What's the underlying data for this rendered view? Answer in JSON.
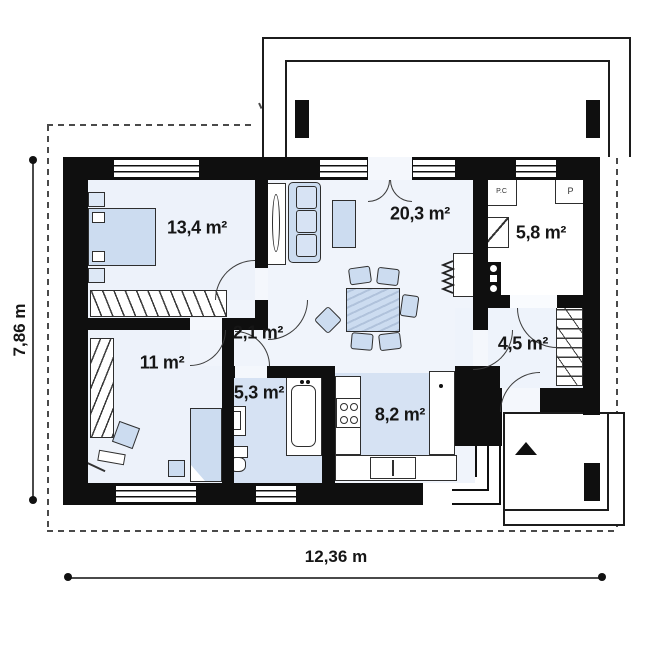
{
  "plan": {
    "type": "house-floor-plan",
    "dimensions": {
      "width_label": "12,36 m",
      "height_label": "7,86 m"
    },
    "rooms": [
      {
        "name": "bedroom",
        "area_label": "13,4 m²"
      },
      {
        "name": "living-room",
        "area_label": "20,3 m²"
      },
      {
        "name": "utility-room",
        "area_label": "5,8 m²"
      },
      {
        "name": "hall",
        "area_label": "2,1 m²"
      },
      {
        "name": "bedroom-2",
        "area_label": "11 m²"
      },
      {
        "name": "bathroom",
        "area_label": "5,3 m²"
      },
      {
        "name": "kitchen",
        "area_label": "8,2 m²"
      },
      {
        "name": "entrance-hall",
        "area_label": "4,5 m²"
      }
    ],
    "appliance_labels": {
      "pc": "P.C",
      "p": "P"
    },
    "colors": {
      "wall": "#0f0f0f",
      "furniture_fill": "#ccdcf0",
      "room_highlight": "#d6e2f3",
      "floor_light": "#eef2fa",
      "dashed_outline": "#4a4a4a"
    }
  }
}
